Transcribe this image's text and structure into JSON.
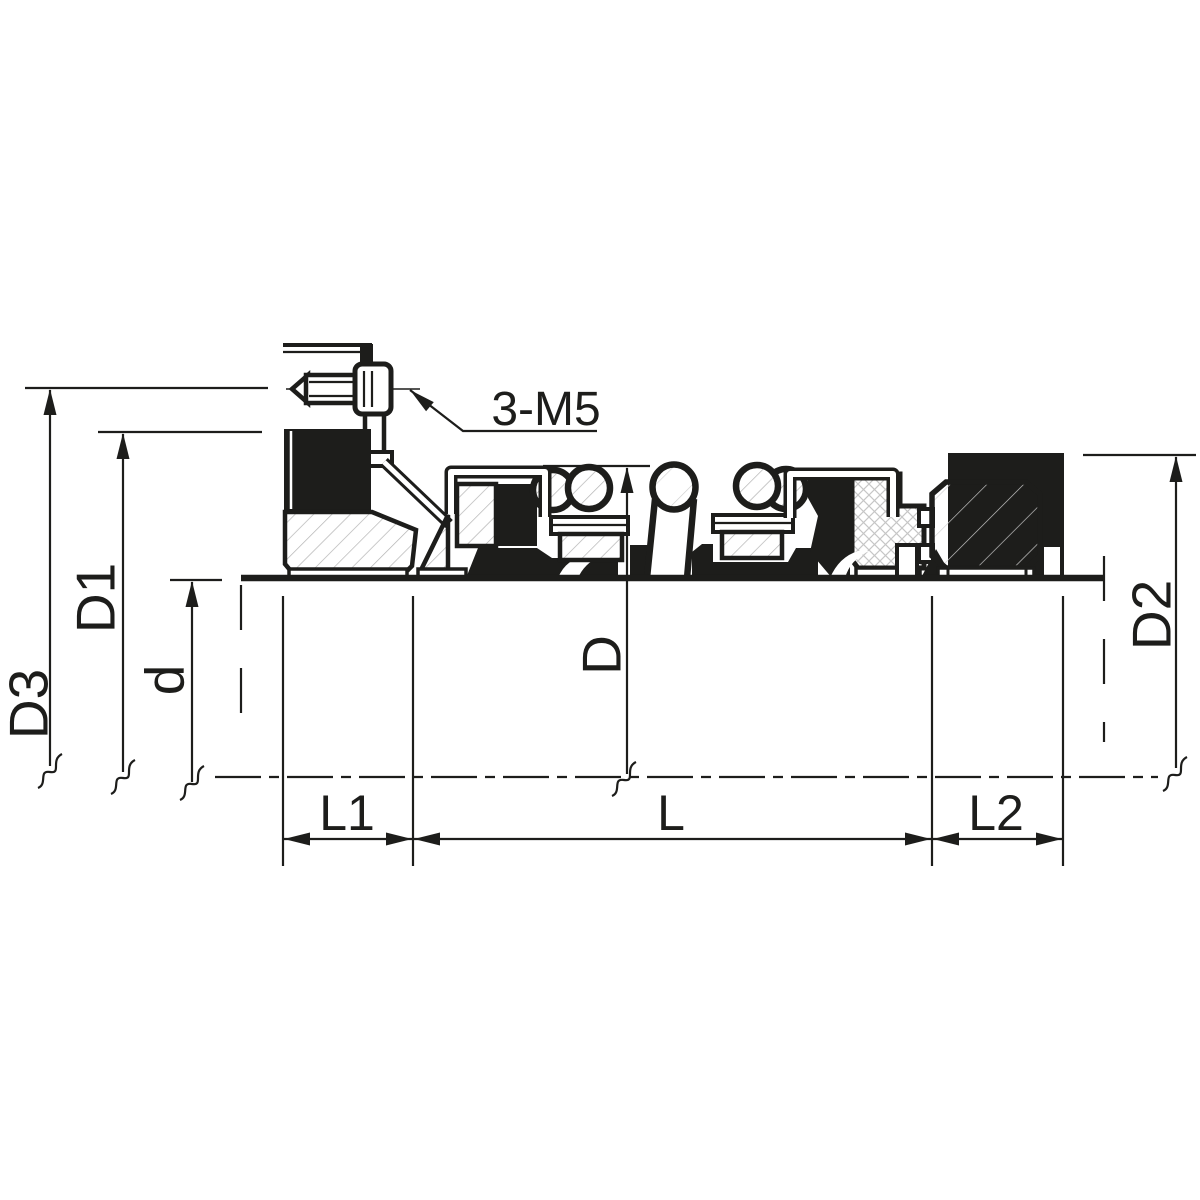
{
  "drawing": {
    "type": "engineering-cross-section",
    "subject": "mechanical seal assembly on shaft, half section",
    "callouts": {
      "screws": "3-M5"
    },
    "dimensions": {
      "D3": "D3",
      "D1": "D1",
      "d": "d",
      "D": "D",
      "D2": "D2",
      "L1": "L1",
      "L": "L",
      "L2": "L2"
    },
    "colors": {
      "ink": "#1d1d1b",
      "background": "#ffffff",
      "hatch_metal": "#b3b3b3",
      "hatch_elastomer": "#c6c6c6",
      "hatch_seat": "#cfcfcf"
    }
  }
}
